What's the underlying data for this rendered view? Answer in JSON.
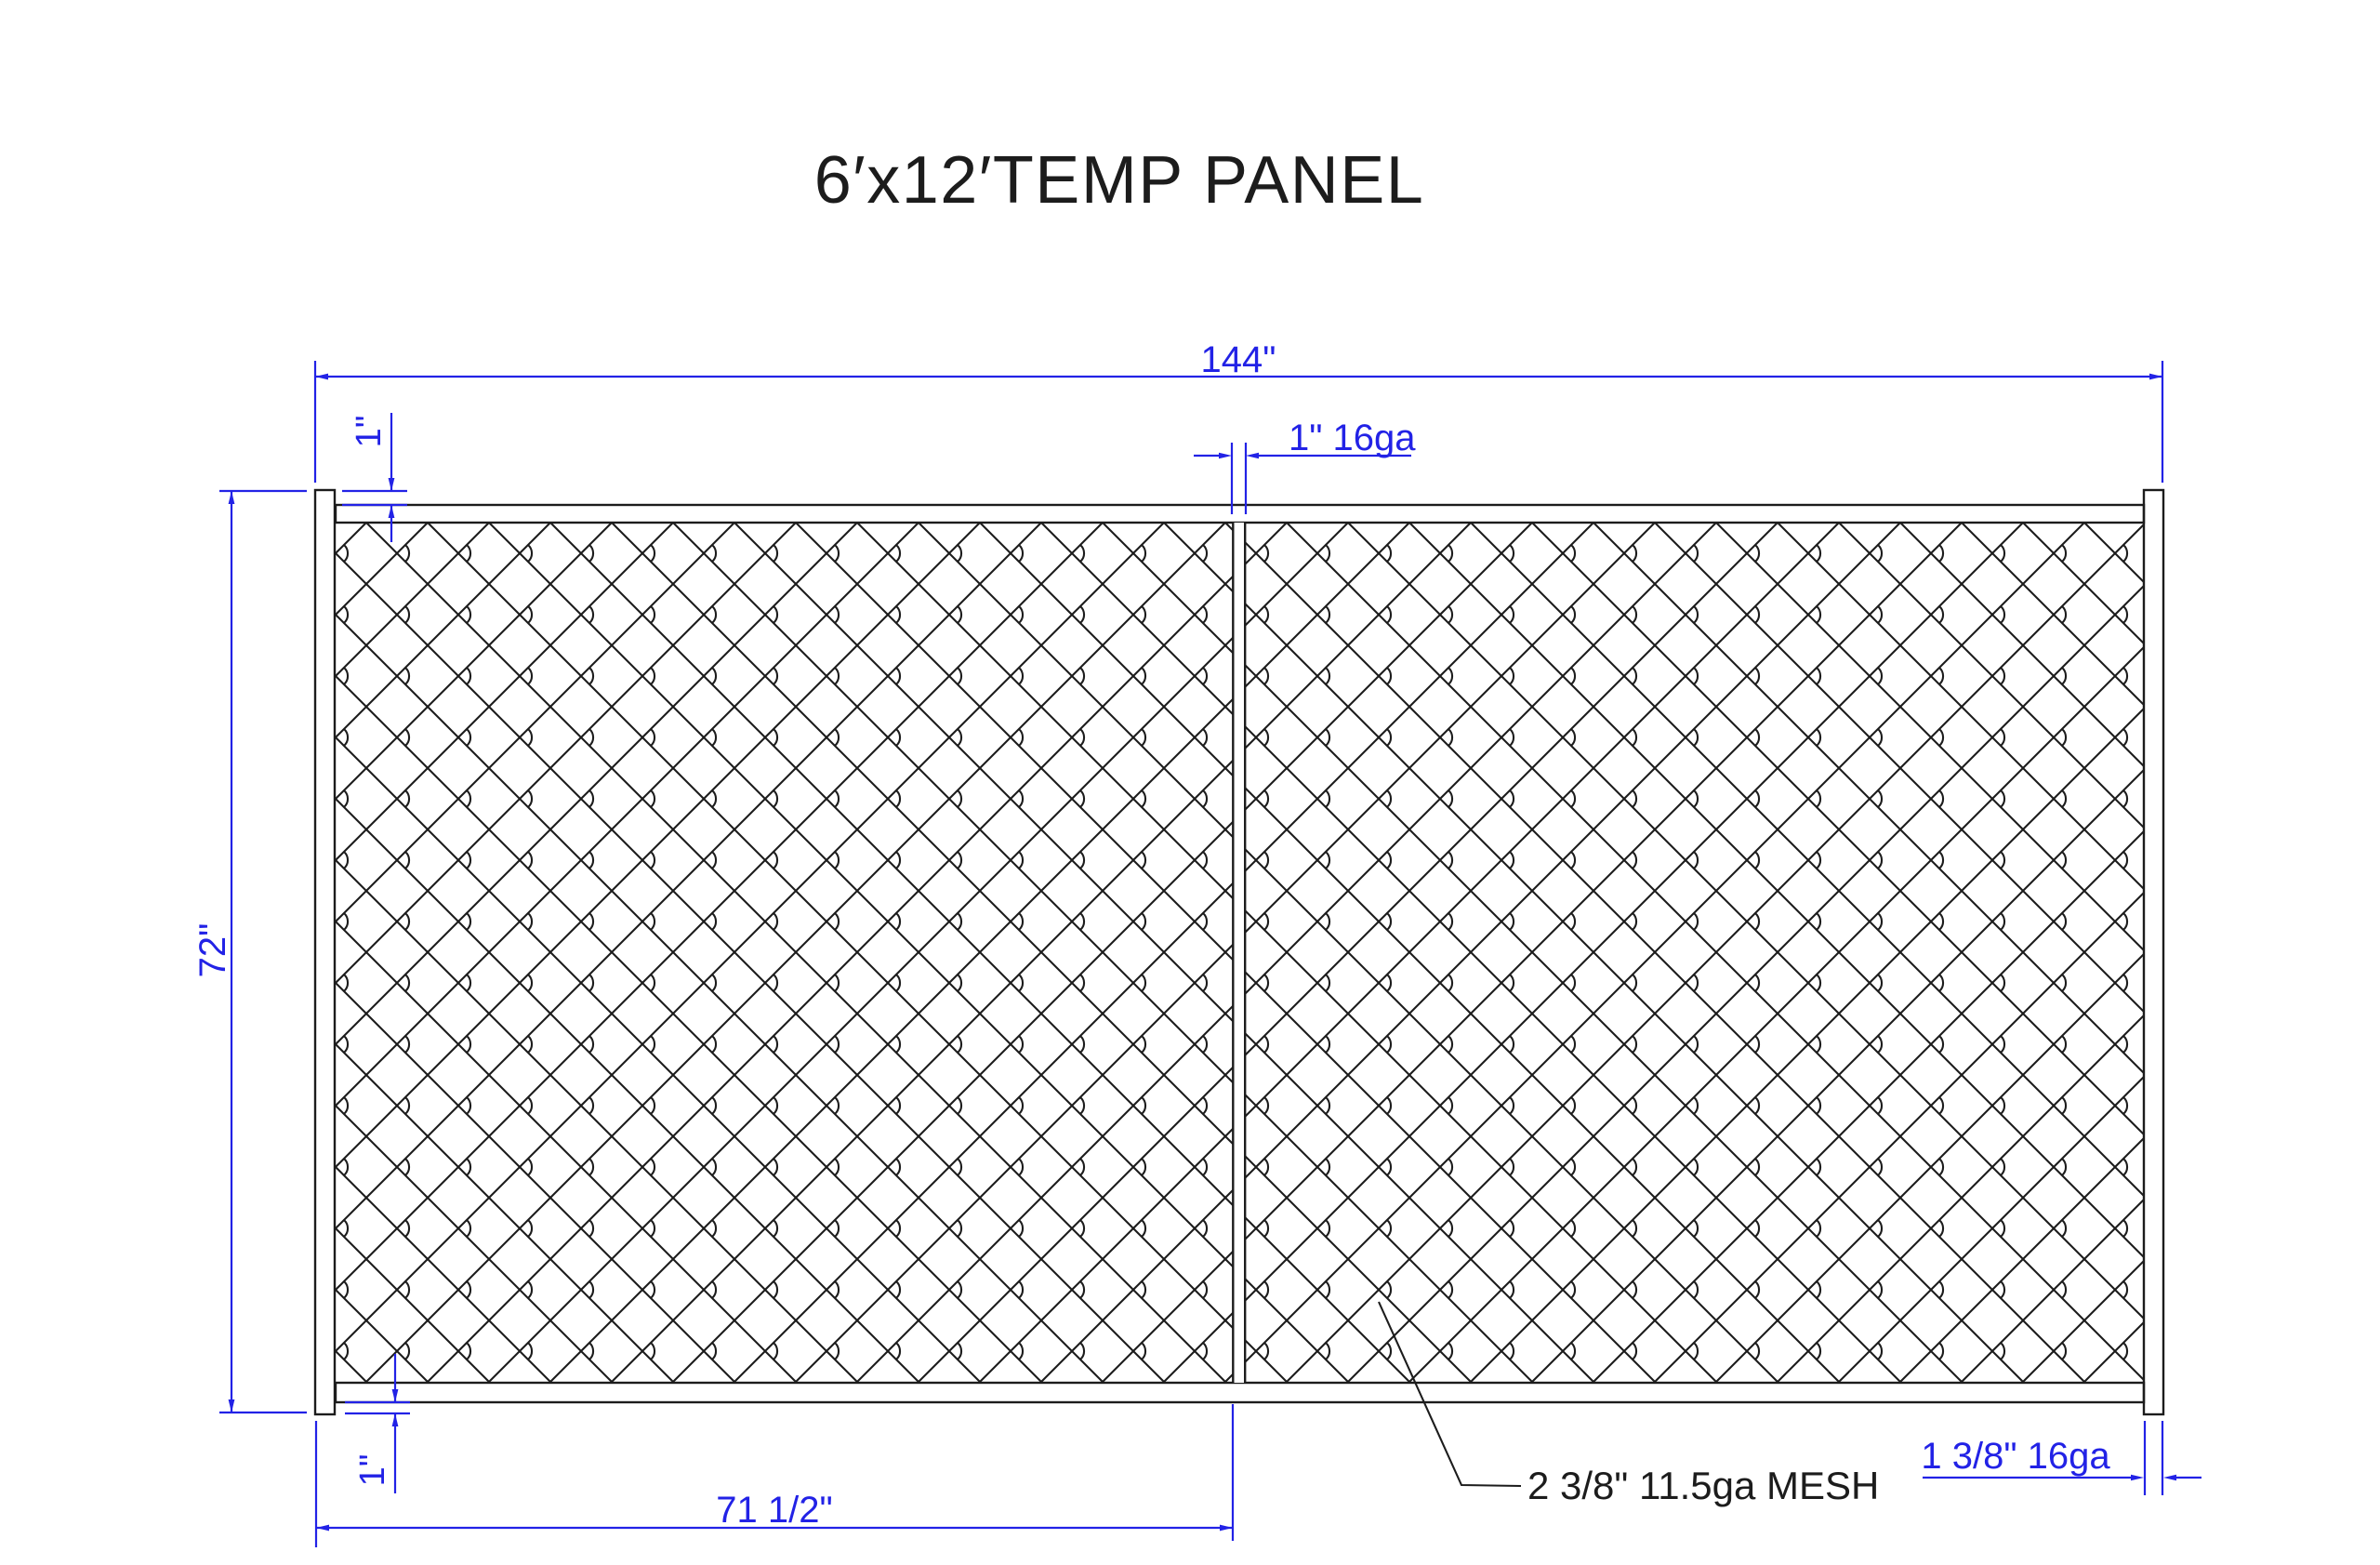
{
  "title": "6′x12′TEMP PANEL",
  "colors": {
    "dimension_blue": "#2222E6",
    "drawing_black": "#1C1C1C",
    "background": "#FFFFFF"
  },
  "dimensions": {
    "overall_width": "144\"",
    "overall_height": "72\"",
    "top_rail_offset": "1\"",
    "bottom_rail_offset": "1\"",
    "center_upright": "1\" 16ga",
    "half_panel_width": "71 1/2\"",
    "frame_tube": "1 3/8\" 16ga"
  },
  "callouts": {
    "mesh": "2 3/8\" 11.5ga MESH"
  }
}
